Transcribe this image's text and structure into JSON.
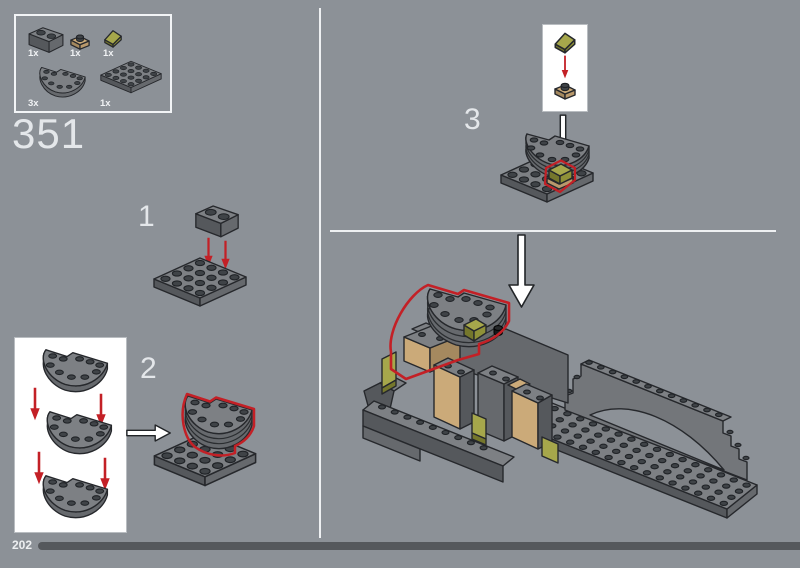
{
  "header": {
    "step_number": "351"
  },
  "parts_box": {
    "items": [
      {
        "qty": "1x",
        "part": "brick-1x2-dark-gray"
      },
      {
        "qty": "1x",
        "part": "plate-1x1-tan"
      },
      {
        "qty": "1x",
        "part": "slope-1x1-olive-green"
      },
      {
        "qty": "3x",
        "part": "plate-4x8-half-circle-dark-gray"
      },
      {
        "qty": "1x",
        "part": "plate-4x4-dark-gray"
      }
    ]
  },
  "substeps": [
    {
      "label": "1"
    },
    {
      "label": "2"
    },
    {
      "label": "3"
    }
  ],
  "footer": {
    "page_number": "202"
  },
  "palette": {
    "background": "#8c9197",
    "highlight_red": "#c32026",
    "divider_white": "#eef0f2",
    "progress_bar": "#55585c",
    "brick_gray": "#7d8084",
    "tan": "#cbaa79",
    "olive_green": "#a6a74b"
  }
}
